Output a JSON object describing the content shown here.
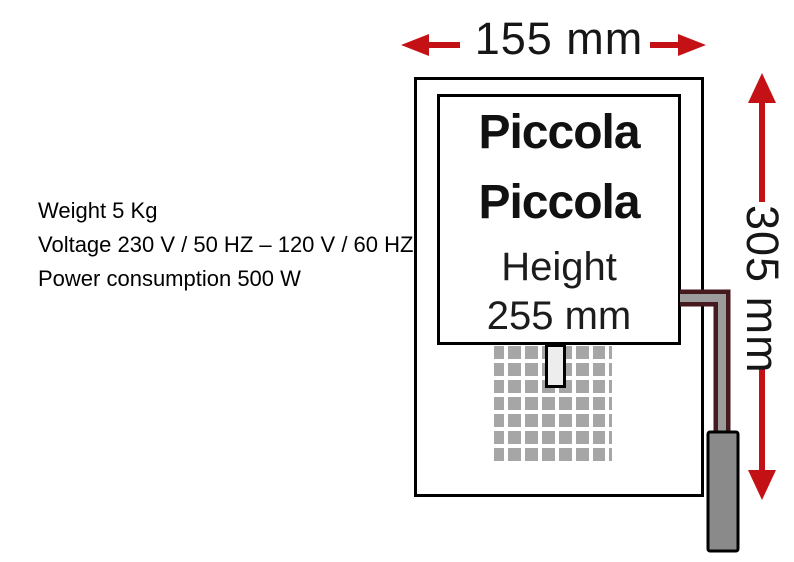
{
  "specs": {
    "weight": "Weight 5 Kg",
    "voltage": "Voltage 230 V / 50 HZ – 120 V / 60 HZ",
    "power": "Power consumption 500 W"
  },
  "dimensions": {
    "width_label": "155 mm",
    "height_label": "305 mm"
  },
  "plate": {
    "brand_line1": "Piccola",
    "brand_line2": "Piccola",
    "caption_line1": "Height",
    "caption_line2": "255 mm"
  },
  "colors": {
    "arrow_red": "#c41116",
    "outline_black": "#000000",
    "grid_gray": "#a6a6a6",
    "cord_outline": "#451a1f",
    "cord_core": "#9c9c9c",
    "plug_gray": "#8a8a8a"
  }
}
